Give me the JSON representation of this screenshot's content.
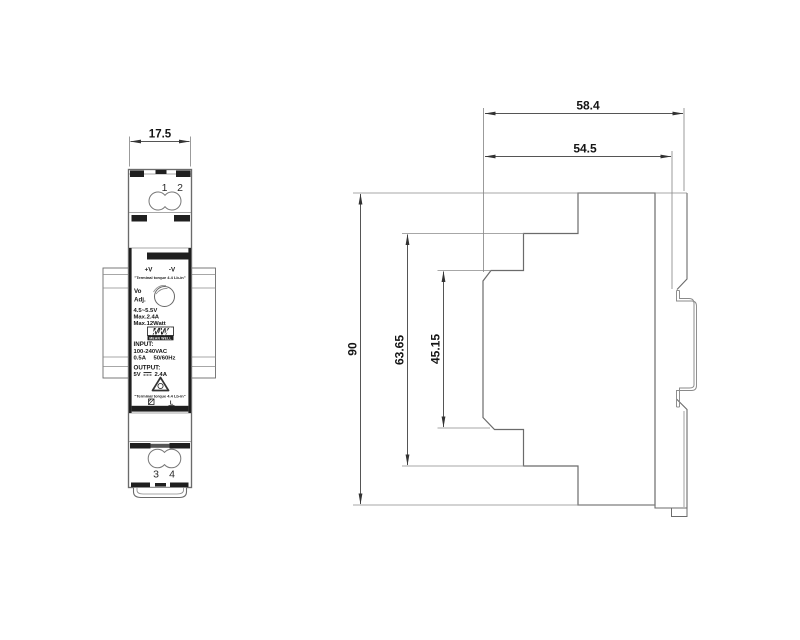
{
  "drawing": {
    "ink": "#3c3c3c",
    "front_view": {
      "width_dim": "17.5",
      "terminal_top_1": "1",
      "terminal_top_2": "2",
      "terminal_bottom_1": "3",
      "terminal_bottom_2": "4",
      "label": {
        "vplus": "+V",
        "vminus": "-V",
        "torque_note": "\"Terminal torque 4.4 Lb-in\"",
        "vo": "Vo",
        "adj": "Adj.",
        "voltage_range": "4.5~5.5V",
        "max_current": "Max.2.4A",
        "max_power": "Max.12Watt",
        "logo": "MW",
        "brand": "MEAN WELL",
        "input_title": "INPUT:",
        "input_voltage": "100-240VAC",
        "input_current": "0.5A",
        "input_freq": "50/60Hz",
        "output_title": "OUTPUT:",
        "output_voltage": "5V",
        "output_current": "2.4A",
        "line_mark": "L"
      }
    },
    "side_view": {
      "depth_overall": "58.4",
      "depth_body": "54.5",
      "height": "90",
      "recess_height": "63.65",
      "slot_height": "45.15"
    }
  }
}
